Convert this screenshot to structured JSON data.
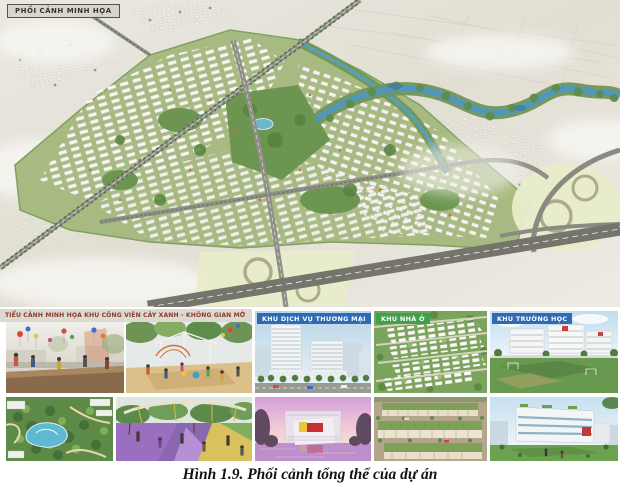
{
  "figure": {
    "caption": "Hình 1.9. Phối cảnh tổng thể của dự án"
  },
  "aerial": {
    "label": "PHỐI CẢNH MINH HỌA"
  },
  "sections": {
    "park": {
      "label": "TIỂU CẢNH MINH HỌA KHU CÔNG VIÊN CÂY XANH - KHÔNG GIAN MỞ"
    },
    "commercial": {
      "label": "KHU DỊCH VỤ THƯƠNG MẠI"
    },
    "residential": {
      "label": "KHU NHÀ Ở"
    },
    "school": {
      "label": "KHU TRƯỜNG HỌC"
    }
  },
  "colors": {
    "aerial_label_bg": "#d8d5ca",
    "aerial_label_border": "#55534b",
    "aerial_label_text": "#35342e",
    "park_label_bg": "#dcd9d0",
    "park_label_text": "#8a3a2e",
    "commercial_label_bg": "#2d6cb5",
    "residential_label_bg": "#3fa04d",
    "school_label_bg": "#2d6cb5",
    "area_label_text": "#ffffff",
    "caption_text": "#111111",
    "terrain": "#e4e1d7",
    "river": "#4f97bd",
    "development_green": "#a6ba80",
    "interchange_fill": "#e9ecca"
  }
}
